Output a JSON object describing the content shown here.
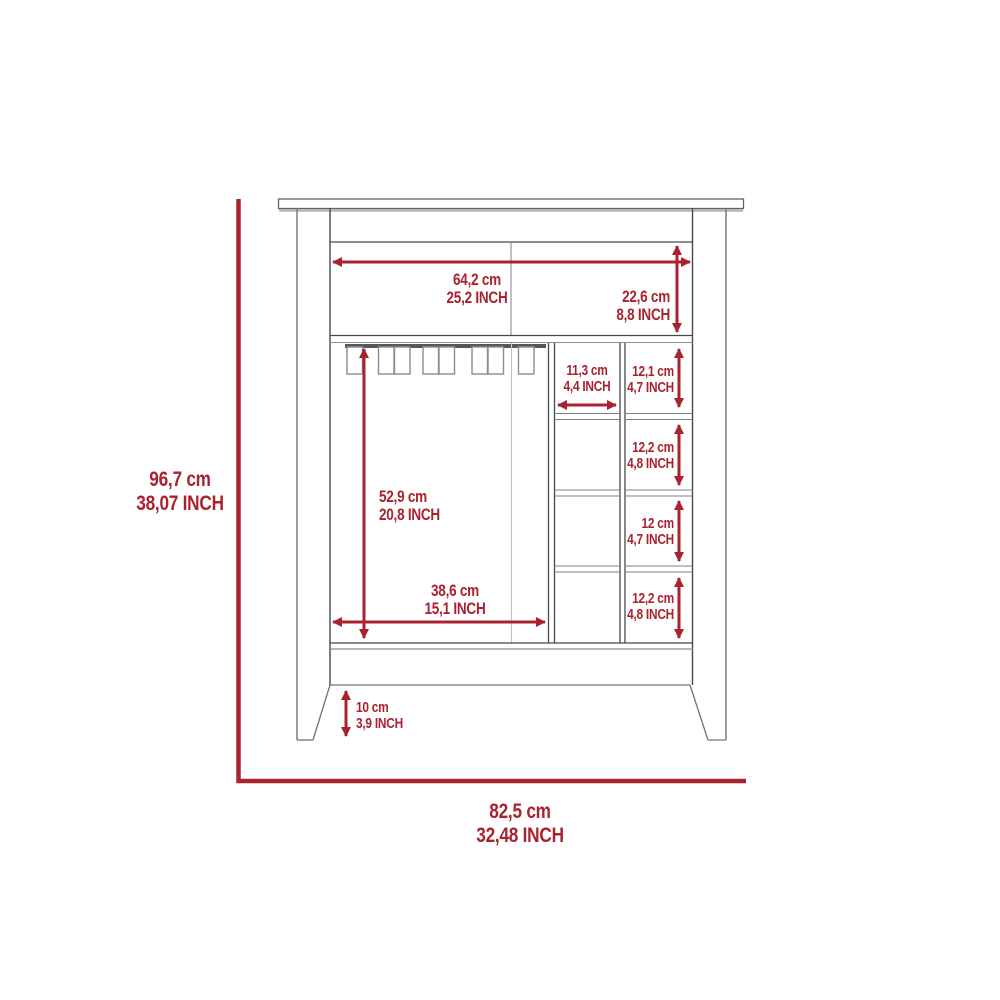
{
  "diagram": {
    "type": "furniture-dimension-drawing",
    "subject": "bar-cabinet-front-view",
    "accent_color": "#a8232f",
    "line_color": "#707478",
    "measurements": {
      "overall_height": {
        "cm": "96,7 cm",
        "inch": "38,07 INCH"
      },
      "overall_width": {
        "cm": "82,5 cm",
        "inch": "32,48 INCH"
      },
      "top_section_width": {
        "cm": "64,2 cm",
        "inch": "25,2 INCH"
      },
      "top_section_height": {
        "cm": "22,6 cm",
        "inch": "8,8 INCH"
      },
      "open_compartment_height": {
        "cm": "52,9 cm",
        "inch": "20,8 INCH"
      },
      "open_compartment_width": {
        "cm": "38,6 cm",
        "inch": "15,1 INCH"
      },
      "cubby_column_width": {
        "cm": "11,3 cm",
        "inch": "4,4 INCH"
      },
      "cubby_1_height": {
        "cm": "12,1 cm",
        "inch": "4,7 INCH"
      },
      "cubby_2_height": {
        "cm": "12,2 cm",
        "inch": "4,8 INCH"
      },
      "cubby_3_height": {
        "cm": "12 cm",
        "inch": "4,7 INCH"
      },
      "cubby_4_height": {
        "cm": "12,2 cm",
        "inch": "4,8 INCH"
      },
      "leg_height": {
        "cm": "10 cm",
        "inch": "3,9 INCH"
      }
    }
  }
}
